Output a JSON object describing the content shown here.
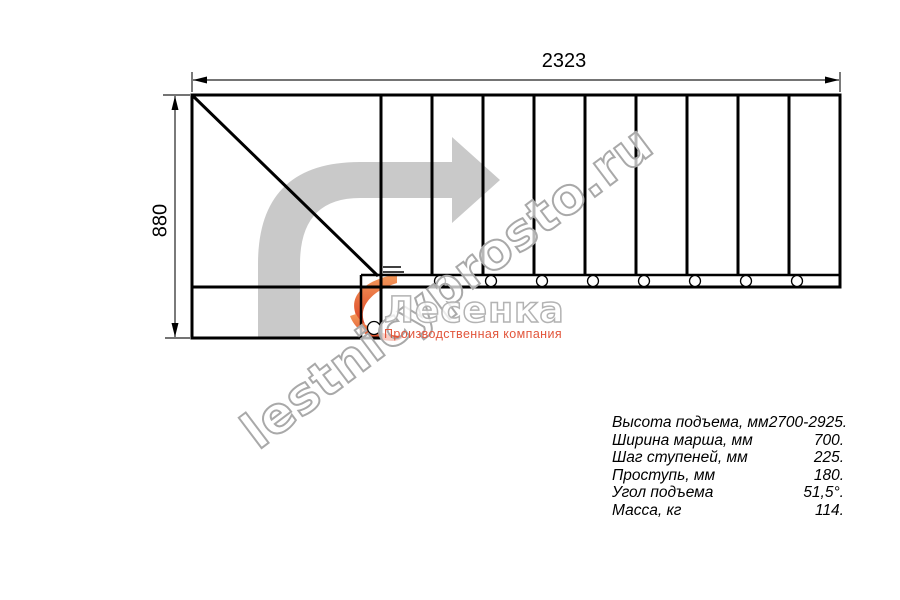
{
  "dimensions": {
    "width_mm": "2323",
    "height_mm": "880"
  },
  "specs": {
    "rows": [
      {
        "label": "Высота подъема, мм",
        "value": "2700-2925."
      },
      {
        "label": "Ширина марша, мм",
        "value": "700."
      },
      {
        "label": "Шаг ступеней, мм",
        "value": "225."
      },
      {
        "label": "Проступь, мм",
        "value": "180."
      },
      {
        "label": "Угол подъема",
        "value": "51,5°."
      },
      {
        "label": "Масса, кг",
        "value": "114."
      }
    ]
  },
  "watermark": {
    "site": "lestnicyprosto.ru",
    "logo": "Лесенка",
    "tagline": "Производственная компания"
  },
  "colors": {
    "line": "#000000",
    "walk_arrow_gray": "#c9c9c9",
    "watermark_gray": "#a9a9a9",
    "brand_orange": "#e2553b"
  }
}
